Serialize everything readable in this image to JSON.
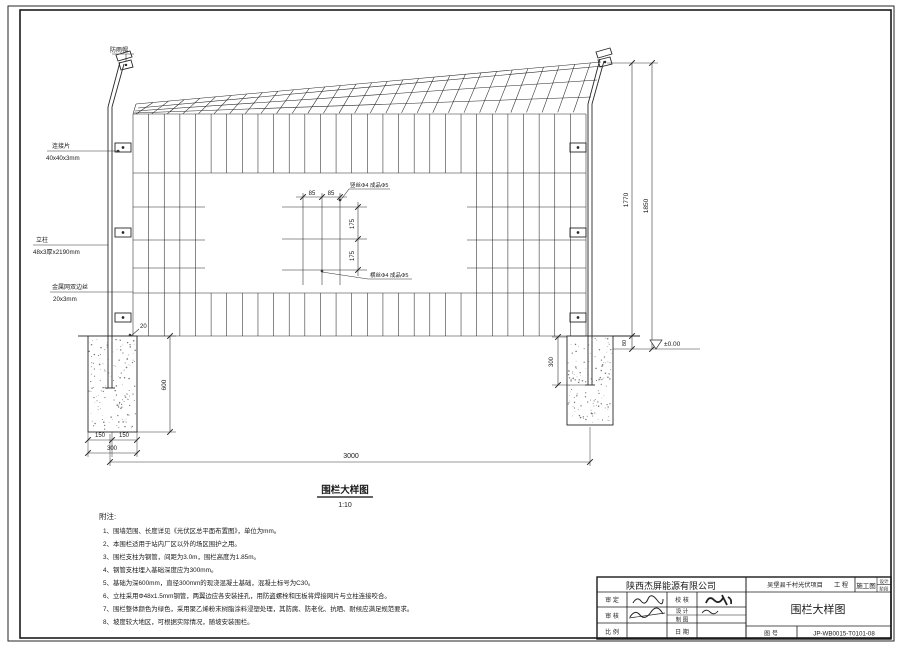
{
  "drawing": {
    "view_title": "围栏大样图",
    "view_scale": "1:10",
    "callouts": {
      "rain_cap": "防雨帽",
      "connector_name": "连接片",
      "connector_spec": "40x40x3mm",
      "post_name": "立柱",
      "post_spec": "48x3厚x2190mm",
      "mesh_name": "金属网双边丝",
      "mesh_spec": "20x3mm",
      "vertical_wire": "竖丝Φ4 成品Φ5",
      "horizontal_wire": "横丝Φ4 成品Φ5"
    },
    "dimensions": {
      "mesh_w1": "85",
      "mesh_w2": "85",
      "mesh_h1": "175",
      "mesh_h2": "175",
      "height_mesh": "1770",
      "height_total": "1850",
      "base_gap": "80",
      "level": "±0.00",
      "embed_depth": "300",
      "post_gap": "20",
      "foundation_depth": "600",
      "foundation_half1": "150",
      "foundation_half2": "150",
      "foundation_width": "300",
      "span": "3000"
    }
  },
  "notes": {
    "heading": "附注:",
    "items": [
      "1、围墙范围、长度详见《光伏区总平面布置图》，单位为mm。",
      "2、本围栏适用于站内厂区以外的场区围护之用。",
      "3、围栏支柱为钢管，间距为3.0m，围栏高度为1.85m。",
      "4、钢管支柱埋入基础深度应为300mm。",
      "5、基础为深600mm，直径300mm的现浇混凝土基础，混凝土标号为C30。",
      "6、立柱采用Φ48x1.5mm钢管，两翼边应各安装挂孔，用防盗螺栓和压板将焊接网片与立柱连接咬合。",
      "7、围栏整体颜色为绿色，采用聚乙烯粉末树脂涂料浸塑处理，其防腐、防老化、抗晒、耐候应满足规范要求。",
      "8、坡度较大地区，可根据实际情况，随坡安装围栏。"
    ]
  },
  "title_block": {
    "company": "陕西杰屏能源有限公司",
    "project": "吴堡县千村光伏项目",
    "project_suffix": "工 程",
    "stage": "施工图",
    "stage_label_1": "设计",
    "stage_label_2": "阶段",
    "fields": {
      "approved": "审 定",
      "reviewed": "审 核",
      "scale": "比 例",
      "checked": "校 核",
      "designed": "设 计",
      "drafted": "制 图",
      "date": "日 期"
    },
    "drawing_title": "围栏大样图",
    "drawing_no_label": "图 号",
    "drawing_no": "JP-WB0015-T0101-08"
  },
  "colors": {
    "line": "#262626",
    "paper": "#ffffff",
    "stipple": "#777777"
  }
}
